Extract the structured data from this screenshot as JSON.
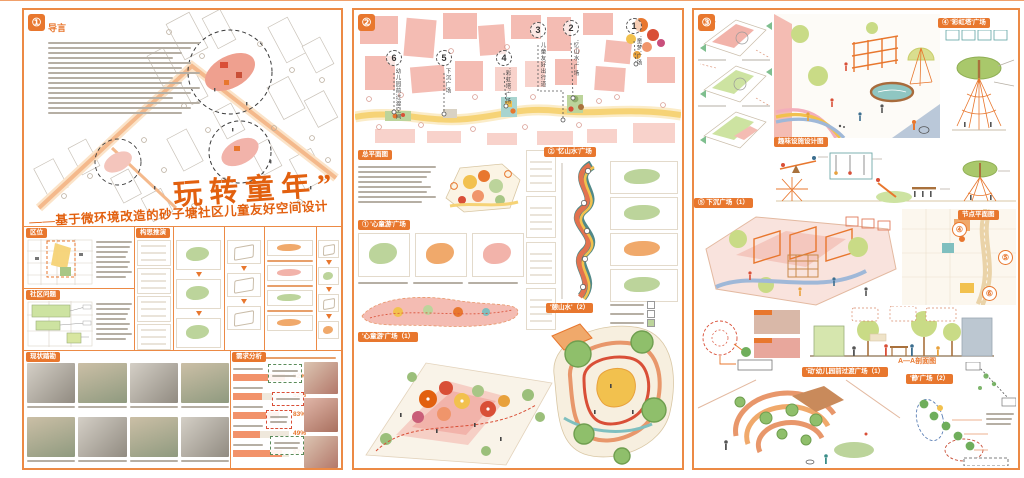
{
  "poster": {
    "colors": {
      "accent": "#E8772E",
      "title_orange": "#E2600F",
      "building_salmon": "#F4BCB3",
      "road_yellow": "#F6D376"
    },
    "panel1": {
      "num": "①",
      "intro_title": "导言",
      "title": "玩转童年”",
      "subtitle": "——基于微环境改造的砂子塘社区儿童友好空间设计",
      "sections": {
        "location": "区位",
        "community_issues": "社区问题",
        "site_survey": "现状踏勘",
        "concept_evolution": "构思推演",
        "demand_analysis": "需求分析"
      },
      "demand_bars": [
        {
          "pct": "92%"
        },
        {
          "pct": "52%"
        },
        {
          "pct": "83%"
        },
        {
          "pct": "49%"
        },
        {
          "pct": "87%"
        }
      ]
    },
    "panel2": {
      "num": "②",
      "master_plan_title": "总平面图",
      "section1_title": "① '心童游'广场",
      "section2_title": "② '忆山水'广场",
      "render1_tag": "'心童游'广场（1）",
      "render2_tag": "'憩山水'（2）",
      "plan_markers": [
        {
          "num": "1",
          "label": "'童梦'广场"
        },
        {
          "num": "2",
          "label": "'忆山水'广场"
        },
        {
          "num": "3",
          "label": "儿童友好出行道"
        },
        {
          "num": "4",
          "label": "'彩虹塔'广场"
        },
        {
          "num": "5",
          "label": "下沉广场"
        },
        {
          "num": "6",
          "label": "幼儿园前过渡空间"
        }
      ]
    },
    "panel3": {
      "num": "③",
      "rainbow_plaza_tag": "④ '彩虹塔'广场",
      "equipment_tag": "趣味设施设计图",
      "sunken_plaza_tag": "⑤ 下沉广场（1）",
      "node_plan_tag": "节点平面图",
      "node_nums": [
        "④",
        "⑤",
        "⑥"
      ],
      "section_label": "A—A剖面图",
      "dong_plaza_tag": "'动'幼儿园前过渡广场（1）",
      "jing_plaza_tag": "'静'广场（2）"
    }
  }
}
